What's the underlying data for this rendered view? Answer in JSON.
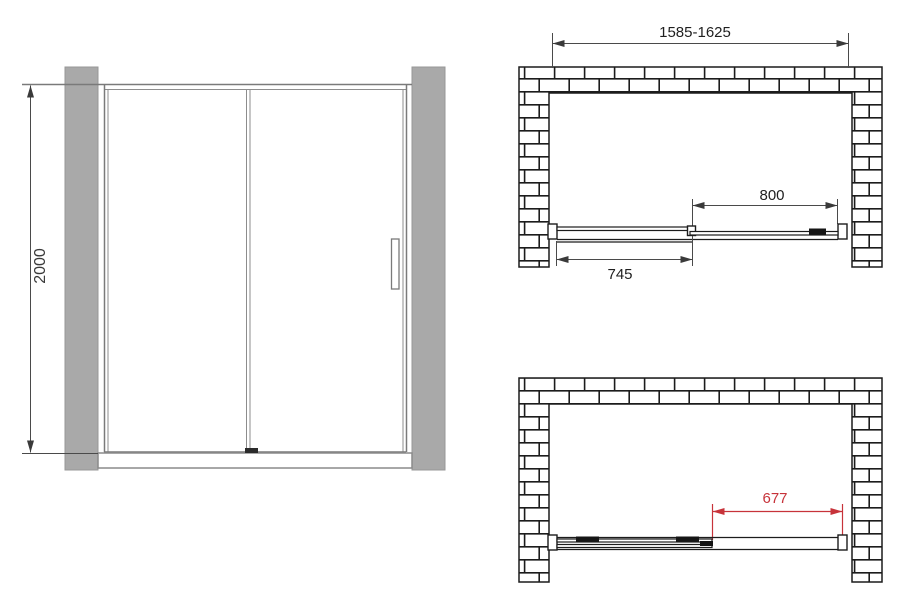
{
  "dimensions": {
    "height": "2000",
    "width_range": "1585-1625",
    "slider_width": "800",
    "fixed_width": "745",
    "open_clearance": "677"
  },
  "colors": {
    "dimension_red": "#c7333a",
    "wall_gray": "#a9a9a9",
    "drawing_line": "#1c1c1c",
    "front_line_gray": "#7a7a7a",
    "background": "#ffffff"
  }
}
